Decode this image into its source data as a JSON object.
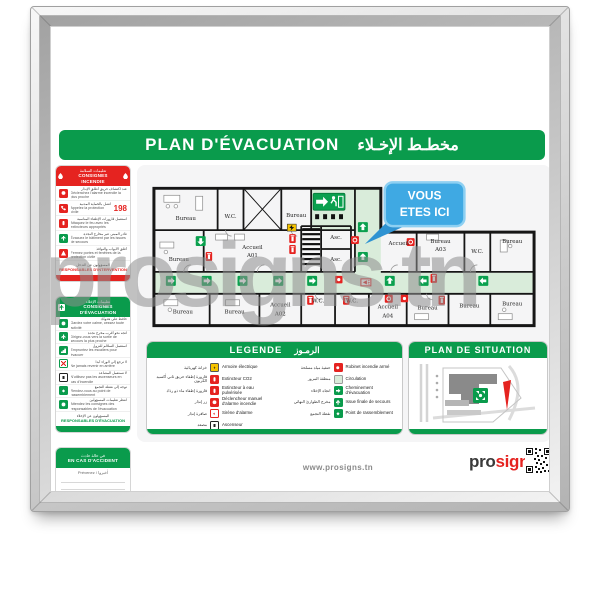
{
  "title": {
    "fr": "PLAN D'ÉVACUATION",
    "ar": "مخطـط الإخـلاء"
  },
  "watermark": "prosigns.tn",
  "sidebar": {
    "incendie": {
      "header_ar": "تعليمات السلامة",
      "header_fr": "CONSIGNES INCENDIE",
      "items": [
        {
          "ar": "عند اكتشاف حريق أطلق الإنذار",
          "fr": "Déclenchez l'alarme incendie la plus proche"
        },
        {
          "ar": "اتصل بالحماية المدنية",
          "fr": "Appelez la protection civile",
          "badge": "198"
        },
        {
          "ar": "استعمل قارورات الإطفاء المناسبة",
          "fr": "Attaquez le feu avec les extincteurs appropriés"
        },
        {
          "ar": "غادر المبنى عبر مخارج النجدة",
          "fr": "Évacuez le bâtiment par les issues de secours"
        },
        {
          "ar": "أغلق الأبواب والنوافذ",
          "fr": "Fermez portes et fenêtres de la protection civile"
        }
      ],
      "footer_ar": "المسؤولون عن التدخل",
      "footer_fr": "RESPONSABLES D'INTERVENTION"
    },
    "evacuation": {
      "header_ar": "تعليمات الإخلاء",
      "header_fr": "CONSIGNES D'ÉVACUATION",
      "items": [
        {
          "ar": "حافظ على هدوئك",
          "fr": "Gardez votre calme, cessez toute activité"
        },
        {
          "ar": "اتجه نحو أقرب مخرج نجدة",
          "fr": "Dirigez-vous vers la sortie de secours la plus proche"
        },
        {
          "ar": "استعمل السلالم للنزول",
          "fr": "Empruntez les escaliers pour évacuer"
        },
        {
          "ar": "لا ترجع إلى الوراء أبدا",
          "fr": "Ne jamais revenir en arrière"
        },
        {
          "ar": "لا تستعمل المصاعد",
          "fr": "N'utilisez pas les ascenseurs en cas d'incendie"
        },
        {
          "ar": "توجه إلى نقطة التجمع",
          "fr": "Rendez-vous au point de rassemblement"
        },
        {
          "ar": "انتظر تعليمات المسؤولين",
          "fr": "Attendez les consignes des responsables de l'évacuation"
        }
      ],
      "footer_ar": "المسؤولون عن الإخلاء",
      "footer_fr": "RESPONSABLES D'ÉVACUATION"
    },
    "accident": {
      "header_ar": "في حالة حادث",
      "header_fr": "EN CAS D'ACCIDENT",
      "note": "Prévenez / أخبروا"
    }
  },
  "plan": {
    "bureau": "Bureau",
    "wc": "W.C.",
    "accueil": "Accueil",
    "a01": "A01",
    "a02": "A02",
    "a03": "A03",
    "a04": "A04",
    "asc": "Asc.",
    "callout": {
      "line1": "VOUS",
      "line2": "ETES ICI"
    }
  },
  "legend": {
    "title_fr": "LEGENDE",
    "title_ar": "الرمـوز",
    "left": [
      {
        "ar": "خزانة كهربائية",
        "fr": "Armoire électrique"
      },
      {
        "ar": "قارورة إطفاء حريق ثاني أكسيد الكربون",
        "fr": "Extincteur CO2"
      },
      {
        "ar": "قارورة إطفاء ماء ذو رذاذ",
        "fr": "Extincteur à eau pulvérisée"
      },
      {
        "ar": "زر إنذار",
        "fr": "Déclencheur manuel d'alarme incendie"
      },
      {
        "ar": "صافرة إنذار",
        "fr": "Sirène d'alarme"
      },
      {
        "ar": "مصعد",
        "fr": "Ascenseur"
      }
    ],
    "right": [
      {
        "ar": "حنفية مياه مسلحة",
        "fr": "Robinet incendie armé"
      },
      {
        "ar": "منطقة المرور",
        "fr": "Circulation"
      },
      {
        "ar": "اتجاه الإخلاء",
        "fr": "Cheminement d'évacuation"
      },
      {
        "ar": "مخرج الطوارئ النهائي",
        "fr": "Issue finale de secours"
      },
      {
        "ar": "نقطة التجمع",
        "fr": "Point de rassemblement"
      }
    ]
  },
  "situation": {
    "title": "PLAN DE SITUATION"
  },
  "footer": {
    "url": "www.prosigns.tn",
    "logo_pro": "pro",
    "logo_signs": "signs"
  },
  "colors": {
    "green": "#0a9b4c",
    "red": "#e52320",
    "blue": "#3fa9e3",
    "circulation": "#d9ecda"
  }
}
